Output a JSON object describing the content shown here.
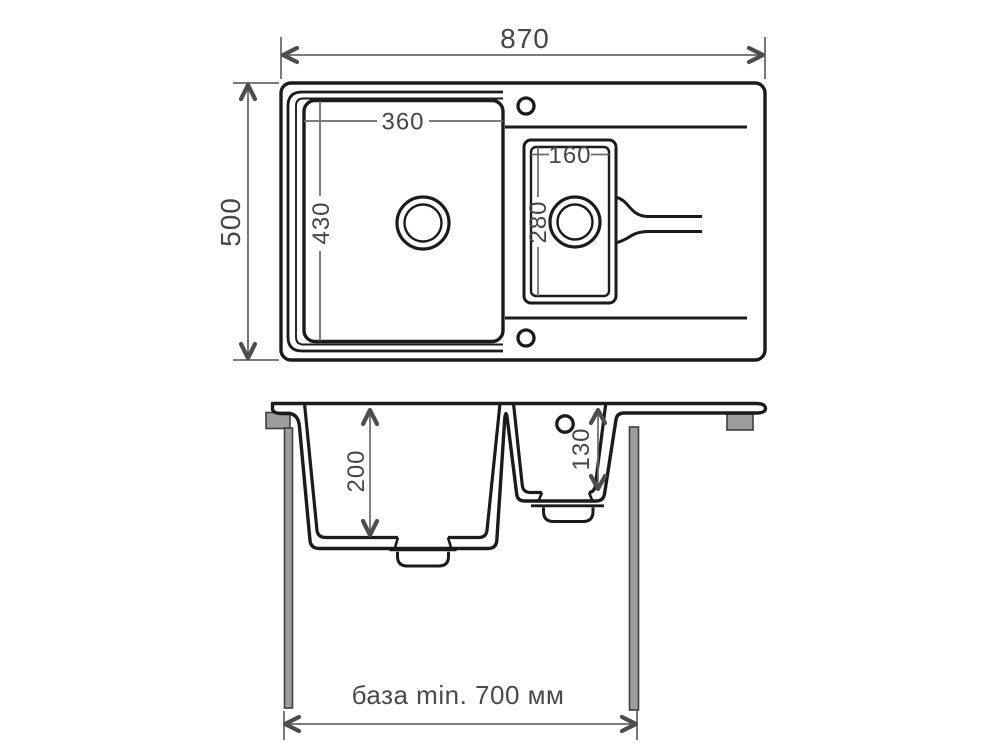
{
  "drawing": {
    "title": "sink-dimension-drawing",
    "top_view": {
      "overall_width_label": "870",
      "overall_depth_label": "500",
      "main_bowl": {
        "width_label": "360",
        "length_label": "430"
      },
      "small_bowl": {
        "width_label": "160",
        "length_label": "280"
      }
    },
    "front_view": {
      "main_bowl_depth_label": "200",
      "small_bowl_depth_label": "130",
      "cabinet_base_label": "база min. 700 мм"
    },
    "colors": {
      "outline": "#1b1b1b",
      "dimension_line": "#6a6a6a",
      "dimension_text": "#464646",
      "arrow": "#4d4d4d",
      "cabinet_fill": "#9d9d9d",
      "cabinet_stroke": "#3f3f3f",
      "background": "#ffffff"
    }
  }
}
